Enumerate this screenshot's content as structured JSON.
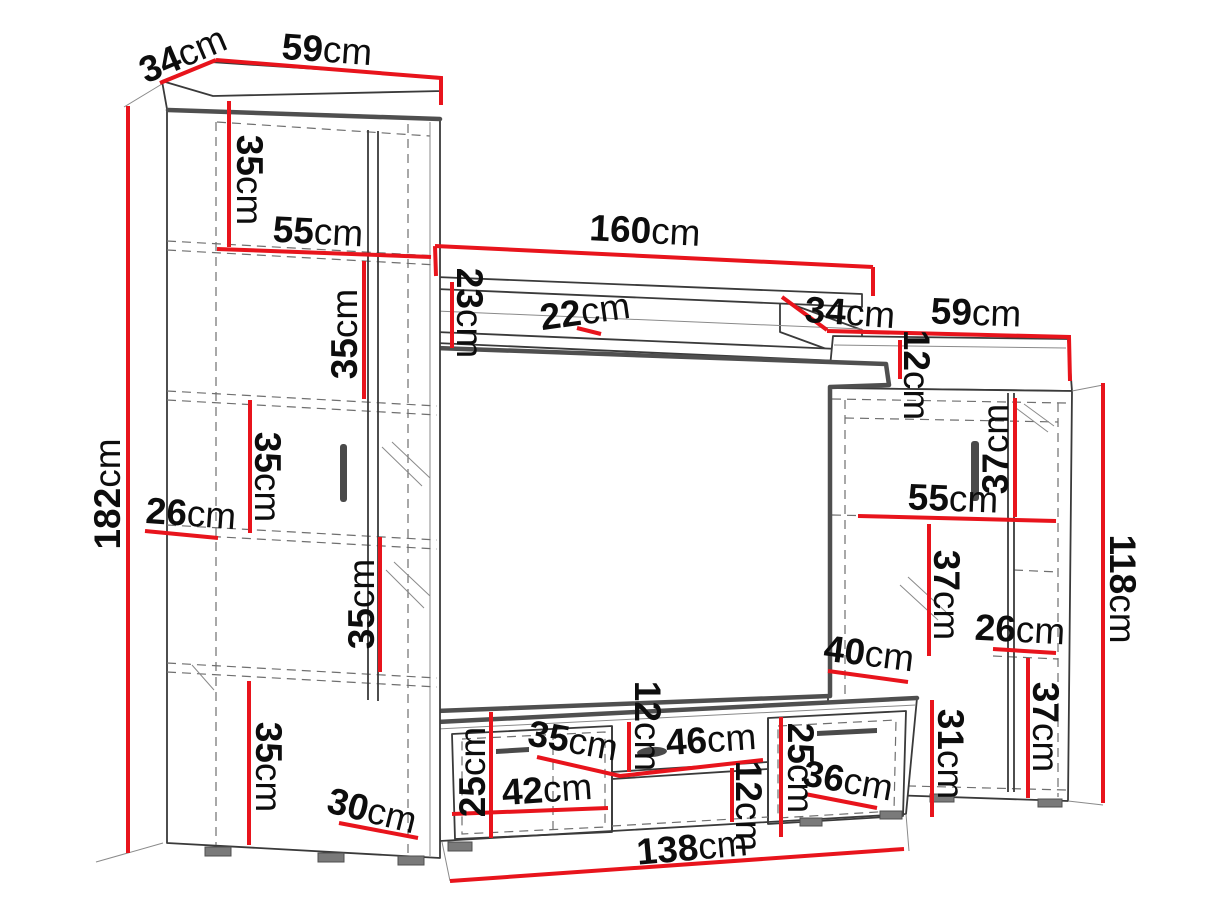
{
  "diagram": {
    "type": "furniture-dimension-diagram",
    "subject": "TV wall unit with tall cabinet, wall shelf, TV panel, media stand and side cabinet",
    "unit": "cm",
    "accent_color": "#e8141c",
    "outline_color": "#3a3a3a",
    "background_color": "#ffffff"
  },
  "dims": [
    {
      "value": "34",
      "unit": "cm"
    },
    {
      "value": "59",
      "unit": "cm"
    },
    {
      "value": "35",
      "unit": "cm"
    },
    {
      "value": "55",
      "unit": "cm"
    },
    {
      "value": "35",
      "unit": "cm"
    },
    {
      "value": "182",
      "unit": "cm"
    },
    {
      "value": "26",
      "unit": "cm"
    },
    {
      "value": "35",
      "unit": "cm"
    },
    {
      "value": "35",
      "unit": "cm"
    },
    {
      "value": "35",
      "unit": "cm"
    },
    {
      "value": "30",
      "unit": "cm"
    },
    {
      "value": "160",
      "unit": "cm"
    },
    {
      "value": "23",
      "unit": "cm"
    },
    {
      "value": "22",
      "unit": "cm"
    },
    {
      "value": "34",
      "unit": "cm"
    },
    {
      "value": "59",
      "unit": "cm"
    },
    {
      "value": "12",
      "unit": "cm"
    },
    {
      "value": "37",
      "unit": "cm"
    },
    {
      "value": "55",
      "unit": "cm"
    },
    {
      "value": "37",
      "unit": "cm"
    },
    {
      "value": "26",
      "unit": "cm"
    },
    {
      "value": "40",
      "unit": "cm"
    },
    {
      "value": "37",
      "unit": "cm"
    },
    {
      "value": "31",
      "unit": "cm"
    },
    {
      "value": "36",
      "unit": "cm"
    },
    {
      "value": "118",
      "unit": "cm"
    },
    {
      "value": "25",
      "unit": "cm"
    },
    {
      "value": "35",
      "unit": "cm"
    },
    {
      "value": "12",
      "unit": "cm"
    },
    {
      "value": "46",
      "unit": "cm"
    },
    {
      "value": "42",
      "unit": "cm"
    },
    {
      "value": "12",
      "unit": "cm"
    },
    {
      "value": "25",
      "unit": "cm"
    },
    {
      "value": "138",
      "unit": "cm"
    }
  ]
}
